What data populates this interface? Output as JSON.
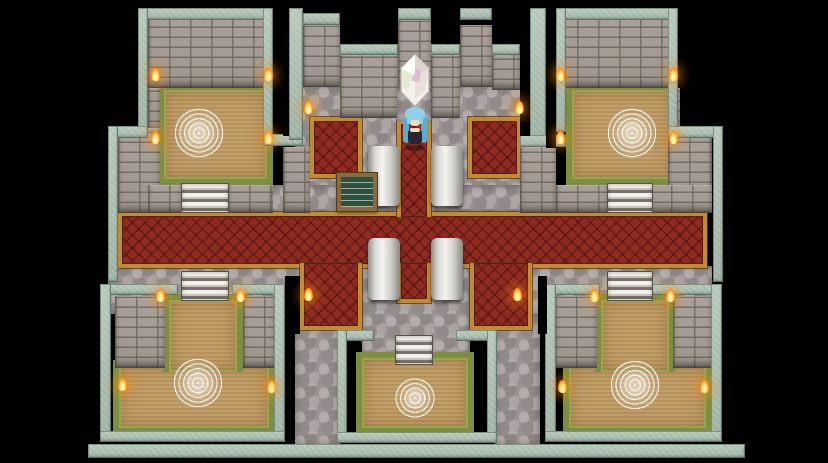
{
  "scene": {
    "name": "castle-interior-map",
    "description": "Top-down RPG castle hall with cross-shaped red carpet, four ritual rooms, pillars, a floating crystal and a blue-haired heroine",
    "background": "#000000"
  },
  "palette": {
    "wall_edge_teal": "#a9bfb1",
    "brick_gray": "#a39b92",
    "cobble_gray": "#9a9392",
    "carpet_red": "#8e2b21",
    "carpet_trim_gold": "#bf8c33",
    "floor_tan": "#c09a62",
    "floor_edge_olive": "#7e8e41",
    "pillar_white": "#f5f4f1",
    "flame_orange": "#ffb33a",
    "magic_circle_white": "#ffffff"
  },
  "map": {
    "regions": [
      {
        "id": "cobble-center-top",
        "type": "cobble",
        "x": 295,
        "y": 85,
        "w": 230,
        "h": 128
      },
      {
        "id": "cobble-band-upper",
        "type": "cobble",
        "x": 112,
        "y": 185,
        "w": 600,
        "h": 28
      },
      {
        "id": "cobble-band-lower",
        "type": "cobble",
        "x": 108,
        "y": 266,
        "w": 604,
        "h": 48
      },
      {
        "id": "cobble-center-bottom",
        "type": "cobble",
        "x": 362,
        "y": 266,
        "w": 108,
        "h": 104
      },
      {
        "id": "cobble-left-passage",
        "type": "cobble",
        "x": 295,
        "y": 314,
        "w": 45,
        "h": 131
      },
      {
        "id": "cobble-right-passage",
        "type": "cobble",
        "x": 495,
        "y": 314,
        "w": 45,
        "h": 131
      },
      {
        "id": "carpet-hall-horizontal",
        "type": "carpet",
        "x": 118,
        "y": 212,
        "w": 589,
        "h": 56
      },
      {
        "id": "carpet-square-topleft",
        "type": "carpet",
        "x": 310,
        "y": 117,
        "w": 52,
        "h": 61
      },
      {
        "id": "carpet-square-topright",
        "type": "carpet",
        "x": 468,
        "y": 117,
        "w": 53,
        "h": 61
      },
      {
        "id": "carpet-leg-bottomleft",
        "type": "carpet",
        "x": 300,
        "y": 263,
        "w": 62,
        "h": 67,
        "trim": "0 1 1 1"
      },
      {
        "id": "carpet-leg-bottomright",
        "type": "carpet",
        "x": 470,
        "y": 263,
        "w": 62,
        "h": 67,
        "trim": "0 1 1 1"
      },
      {
        "id": "carpet-aisle-top",
        "type": "carpet",
        "x": 397,
        "y": 120,
        "w": 34,
        "h": 97,
        "trim": "1 1 0 1"
      },
      {
        "id": "carpet-aisle-bottom",
        "type": "carpet",
        "x": 397,
        "y": 263,
        "w": 34,
        "h": 40,
        "trim": "0 1 1 1"
      },
      {
        "id": "room-topleft-floor",
        "type": "floor",
        "x": 158,
        "y": 84,
        "w": 115,
        "h": 101
      },
      {
        "id": "room-topright-floor",
        "type": "floor",
        "x": 566,
        "y": 84,
        "w": 112,
        "h": 101
      },
      {
        "id": "room-bottomleft-floor-lower",
        "type": "floor",
        "x": 113,
        "y": 360,
        "w": 162,
        "h": 74
      },
      {
        "id": "room-bottomleft-floor-upper",
        "type": "floor",
        "x": 163,
        "y": 294,
        "w": 80,
        "h": 78,
        "trim": "1 1 0 1"
      },
      {
        "id": "room-bottomright-floor-lower",
        "type": "floor",
        "x": 563,
        "y": 360,
        "w": 149,
        "h": 74
      },
      {
        "id": "room-bottomright-floor-upper",
        "type": "floor",
        "x": 595,
        "y": 294,
        "w": 80,
        "h": 78,
        "trim": "1 1 0 1"
      },
      {
        "id": "room-bottomcenter-floor",
        "type": "floor",
        "x": 356,
        "y": 352,
        "w": 118,
        "h": 82
      },
      {
        "id": "wall-topleft-face",
        "type": "brick",
        "x": 148,
        "y": 18,
        "w": 125,
        "h": 70
      },
      {
        "id": "wall-topleft-side-a",
        "type": "brick",
        "x": 148,
        "y": 88,
        "w": 12,
        "h": 44
      },
      {
        "id": "wall-topleft-side-b",
        "type": "brick",
        "x": 118,
        "y": 128,
        "w": 42,
        "h": 85
      },
      {
        "id": "pier-topleft-stairs-l",
        "type": "brick",
        "x": 148,
        "y": 185,
        "w": 34,
        "h": 28
      },
      {
        "id": "pier-topleft-stairs-r",
        "type": "brick",
        "x": 228,
        "y": 185,
        "w": 45,
        "h": 28
      },
      {
        "id": "wall-topright-face",
        "type": "brick",
        "x": 556,
        "y": 18,
        "w": 122,
        "h": 70
      },
      {
        "id": "wall-topright-side-a",
        "type": "brick",
        "x": 668,
        "y": 88,
        "w": 12,
        "h": 44
      },
      {
        "id": "wall-topright-side-b",
        "type": "brick",
        "x": 668,
        "y": 128,
        "w": 44,
        "h": 85
      },
      {
        "id": "pier-topright-stairs-l",
        "type": "brick",
        "x": 556,
        "y": 185,
        "w": 52,
        "h": 28
      },
      {
        "id": "pier-topright-stairs-r",
        "type": "brick",
        "x": 650,
        "y": 185,
        "w": 62,
        "h": 28
      },
      {
        "id": "tower-left-face",
        "type": "brick",
        "x": 303,
        "y": 25,
        "w": 37,
        "h": 62
      },
      {
        "id": "wall-midleft-face",
        "type": "brick",
        "x": 340,
        "y": 55,
        "w": 58,
        "h": 63
      },
      {
        "id": "tower-center-face",
        "type": "brick",
        "x": 398,
        "y": 20,
        "w": 33,
        "h": 102
      },
      {
        "id": "wall-midright-face",
        "type": "brick",
        "x": 431,
        "y": 55,
        "w": 29,
        "h": 63
      },
      {
        "id": "tower-right-face",
        "type": "brick",
        "x": 460,
        "y": 25,
        "w": 32,
        "h": 62
      },
      {
        "id": "wall-farright-face",
        "type": "brick",
        "x": 492,
        "y": 54,
        "w": 28,
        "h": 36
      },
      {
        "id": "pier-center-left",
        "type": "brick",
        "x": 283,
        "y": 147,
        "w": 27,
        "h": 66
      },
      {
        "id": "pier-center-right",
        "type": "brick",
        "x": 520,
        "y": 147,
        "w": 36,
        "h": 66
      },
      {
        "id": "pier-bottomleft-l",
        "type": "brick",
        "x": 115,
        "y": 296,
        "w": 50,
        "h": 72
      },
      {
        "id": "pier-bottomleft-r",
        "type": "brick",
        "x": 243,
        "y": 296,
        "w": 32,
        "h": 72
      },
      {
        "id": "pier-bottomright-l",
        "type": "brick",
        "x": 555,
        "y": 296,
        "w": 42,
        "h": 72
      },
      {
        "id": "pier-bottomright-r",
        "type": "brick",
        "x": 673,
        "y": 296,
        "w": 39,
        "h": 72
      },
      {
        "id": "edge-topleft-top",
        "type": "teal",
        "x": 138,
        "y": 8,
        "w": 135,
        "h": 12
      },
      {
        "id": "edge-topleft-left-hi",
        "type": "teal",
        "x": 138,
        "y": 8,
        "w": 10,
        "h": 124
      },
      {
        "id": "edge-topleft-step",
        "type": "teal",
        "x": 108,
        "y": 126,
        "w": 40,
        "h": 12
      },
      {
        "id": "edge-topleft-left-lo",
        "type": "teal",
        "x": 108,
        "y": 126,
        "w": 10,
        "h": 156
      },
      {
        "id": "edge-topleft-right",
        "type": "teal",
        "x": 263,
        "y": 8,
        "w": 10,
        "h": 132
      },
      {
        "id": "edge-niche-left-cap",
        "type": "teal",
        "x": 263,
        "y": 134,
        "w": 40,
        "h": 12
      },
      {
        "id": "fin-left",
        "type": "teal",
        "x": 289,
        "y": 8,
        "w": 14,
        "h": 132
      },
      {
        "id": "cap-tower-left",
        "type": "teal",
        "x": 303,
        "y": 13,
        "w": 37,
        "h": 12
      },
      {
        "id": "cap-midleft",
        "type": "teal",
        "x": 340,
        "y": 44,
        "w": 58,
        "h": 11
      },
      {
        "id": "cap-tower-center",
        "type": "teal",
        "x": 398,
        "y": 8,
        "w": 33,
        "h": 12
      },
      {
        "id": "cap-midright",
        "type": "teal",
        "x": 431,
        "y": 44,
        "w": 29,
        "h": 11
      },
      {
        "id": "cap-tower-right",
        "type": "teal",
        "x": 460,
        "y": 8,
        "w": 32,
        "h": 12
      },
      {
        "id": "cap-farright",
        "type": "teal",
        "x": 492,
        "y": 44,
        "w": 28,
        "h": 11
      },
      {
        "id": "fin-right",
        "type": "teal",
        "x": 530,
        "y": 8,
        "w": 16,
        "h": 132
      },
      {
        "id": "edge-niche-right-cap",
        "type": "teal",
        "x": 520,
        "y": 135,
        "w": 46,
        "h": 12
      },
      {
        "id": "edge-topright-top",
        "type": "teal",
        "x": 556,
        "y": 8,
        "w": 122,
        "h": 12
      },
      {
        "id": "edge-topright-left",
        "type": "teal",
        "x": 556,
        "y": 8,
        "w": 10,
        "h": 124
      },
      {
        "id": "edge-topright-right-hi",
        "type": "teal",
        "x": 668,
        "y": 8,
        "w": 10,
        "h": 128
      },
      {
        "id": "edge-topright-step",
        "type": "teal",
        "x": 668,
        "y": 126,
        "w": 55,
        "h": 12
      },
      {
        "id": "edge-topright-right-lo",
        "type": "teal",
        "x": 713,
        "y": 126,
        "w": 10,
        "h": 156
      },
      {
        "id": "edge-bottomleft-top-l",
        "type": "teal",
        "x": 100,
        "y": 284,
        "w": 78,
        "h": 11
      },
      {
        "id": "edge-bottomleft-top-r",
        "type": "teal",
        "x": 232,
        "y": 284,
        "w": 53,
        "h": 11
      },
      {
        "id": "edge-bottomleft-left",
        "type": "teal",
        "x": 100,
        "y": 284,
        "w": 11,
        "h": 158
      },
      {
        "id": "edge-bottomleft-right",
        "type": "teal",
        "x": 274,
        "y": 284,
        "w": 11,
        "h": 158
      },
      {
        "id": "edge-bottomleft-bottom",
        "type": "teal",
        "x": 100,
        "y": 431,
        "w": 185,
        "h": 11
      },
      {
        "id": "edge-bottomright-top-l",
        "type": "teal",
        "x": 545,
        "y": 284,
        "w": 55,
        "h": 11
      },
      {
        "id": "edge-bottomright-top-r",
        "type": "teal",
        "x": 650,
        "y": 284,
        "w": 72,
        "h": 11
      },
      {
        "id": "edge-bottomright-left",
        "type": "teal",
        "x": 545,
        "y": 284,
        "w": 11,
        "h": 158
      },
      {
        "id": "edge-bottomright-right",
        "type": "teal",
        "x": 711,
        "y": 284,
        "w": 11,
        "h": 158
      },
      {
        "id": "edge-bottomright-bottom",
        "type": "teal",
        "x": 545,
        "y": 431,
        "w": 177,
        "h": 11
      },
      {
        "id": "edge-bottomcenter-top-l",
        "type": "teal",
        "x": 337,
        "y": 330,
        "w": 37,
        "h": 11
      },
      {
        "id": "edge-bottomcenter-top-r",
        "type": "teal",
        "x": 456,
        "y": 330,
        "w": 41,
        "h": 11
      },
      {
        "id": "edge-bottomcenter-left",
        "type": "teal",
        "x": 337,
        "y": 330,
        "w": 10,
        "h": 113
      },
      {
        "id": "edge-bottomcenter-right",
        "type": "teal",
        "x": 487,
        "y": 330,
        "w": 10,
        "h": 113
      },
      {
        "id": "edge-bottomcenter-bottom",
        "type": "teal",
        "x": 337,
        "y": 432,
        "w": 160,
        "h": 11
      },
      {
        "id": "bottom-rampart-bar",
        "type": "teal",
        "x": 88,
        "y": 444,
        "w": 657,
        "h": 14
      },
      {
        "id": "crystal-niche-cobble",
        "type": "cobble",
        "x": 397,
        "y": 88,
        "w": 34,
        "h": 34
      },
      {
        "id": "slot-left",
        "type": "slot",
        "x": 283,
        "y": 18,
        "w": 6,
        "h": 118
      },
      {
        "id": "slot-right-a",
        "type": "slot",
        "x": 520,
        "y": 18,
        "w": 10,
        "h": 118
      },
      {
        "id": "slot-right-b",
        "type": "slot",
        "x": 546,
        "y": 18,
        "w": 10,
        "h": 130
      },
      {
        "id": "slot-bottomleft",
        "type": "slot",
        "x": 285,
        "y": 276,
        "w": 15,
        "h": 58
      },
      {
        "id": "slot-bottomright",
        "type": "slot",
        "x": 538,
        "y": 276,
        "w": 9,
        "h": 58
      }
    ]
  },
  "sprites": {
    "stairs": [
      {
        "id": "stairs-room-topleft",
        "x": 182,
        "y": 184,
        "w": 46,
        "h": 28
      },
      {
        "id": "stairs-room-topright",
        "x": 608,
        "y": 184,
        "w": 44,
        "h": 28
      },
      {
        "id": "stairs-room-bottomleft",
        "x": 182,
        "y": 272,
        "w": 46,
        "h": 28
      },
      {
        "id": "stairs-room-bottomright",
        "x": 608,
        "y": 272,
        "w": 44,
        "h": 28
      },
      {
        "id": "stairs-room-bottomcenter",
        "x": 396,
        "y": 336,
        "w": 36,
        "h": 28
      }
    ],
    "magic_circles": [
      {
        "id": "magic-circle-topleft",
        "x": 173,
        "y": 107,
        "d": 52
      },
      {
        "id": "magic-circle-topright",
        "x": 606,
        "y": 107,
        "d": 52
      },
      {
        "id": "magic-circle-bottomleft",
        "x": 172,
        "y": 357,
        "d": 52
      },
      {
        "id": "magic-circle-bottomright",
        "x": 609,
        "y": 359,
        "d": 52
      },
      {
        "id": "magic-circle-bottomcenter",
        "x": 395,
        "y": 378,
        "d": 40
      }
    ],
    "pillars": [
      {
        "id": "pillar-northwest",
        "x": 368,
        "y": 146,
        "w": 32,
        "h": 60
      },
      {
        "id": "pillar-northeast",
        "x": 431,
        "y": 146,
        "w": 32,
        "h": 60
      },
      {
        "id": "pillar-southwest",
        "x": 368,
        "y": 238,
        "w": 32,
        "h": 62
      },
      {
        "id": "pillar-southeast",
        "x": 431,
        "y": 238,
        "w": 32,
        "h": 62
      }
    ],
    "torches": [
      {
        "x": 155,
        "y": 74
      },
      {
        "x": 268,
        "y": 74
      },
      {
        "x": 155,
        "y": 137
      },
      {
        "x": 268,
        "y": 137
      },
      {
        "x": 560,
        "y": 74
      },
      {
        "x": 673,
        "y": 74
      },
      {
        "x": 560,
        "y": 137
      },
      {
        "x": 673,
        "y": 137
      },
      {
        "x": 308,
        "y": 107
      },
      {
        "x": 519,
        "y": 107
      },
      {
        "x": 160,
        "y": 295
      },
      {
        "x": 240,
        "y": 295
      },
      {
        "x": 308,
        "y": 294
      },
      {
        "x": 517,
        "y": 294
      },
      {
        "x": 594,
        "y": 295
      },
      {
        "x": 670,
        "y": 295
      },
      {
        "x": 122,
        "y": 384
      },
      {
        "x": 271,
        "y": 386
      },
      {
        "x": 562,
        "y": 386
      },
      {
        "x": 704,
        "y": 386
      }
    ],
    "notice_board": {
      "id": "notice-board",
      "x": 337,
      "y": 173,
      "w": 40,
      "h": 38
    },
    "crystal": {
      "id": "save-crystal",
      "x": 397,
      "y": 54,
      "w": 36,
      "h": 53,
      "colors": {
        "body": "#f4f1ec",
        "shade": "#ddd6cf",
        "pink": "#e2aed0",
        "green": "#d5e3c4",
        "outline": "#b8b0a5"
      }
    },
    "character": {
      "id": "player-character",
      "x": 402,
      "y": 105,
      "w": 26,
      "h": 47,
      "colors": {
        "hair": "#8fd2e8",
        "hair_dark": "#57aed2",
        "skin": "#f4d9c2",
        "outfit": "#2b2530"
      }
    }
  }
}
